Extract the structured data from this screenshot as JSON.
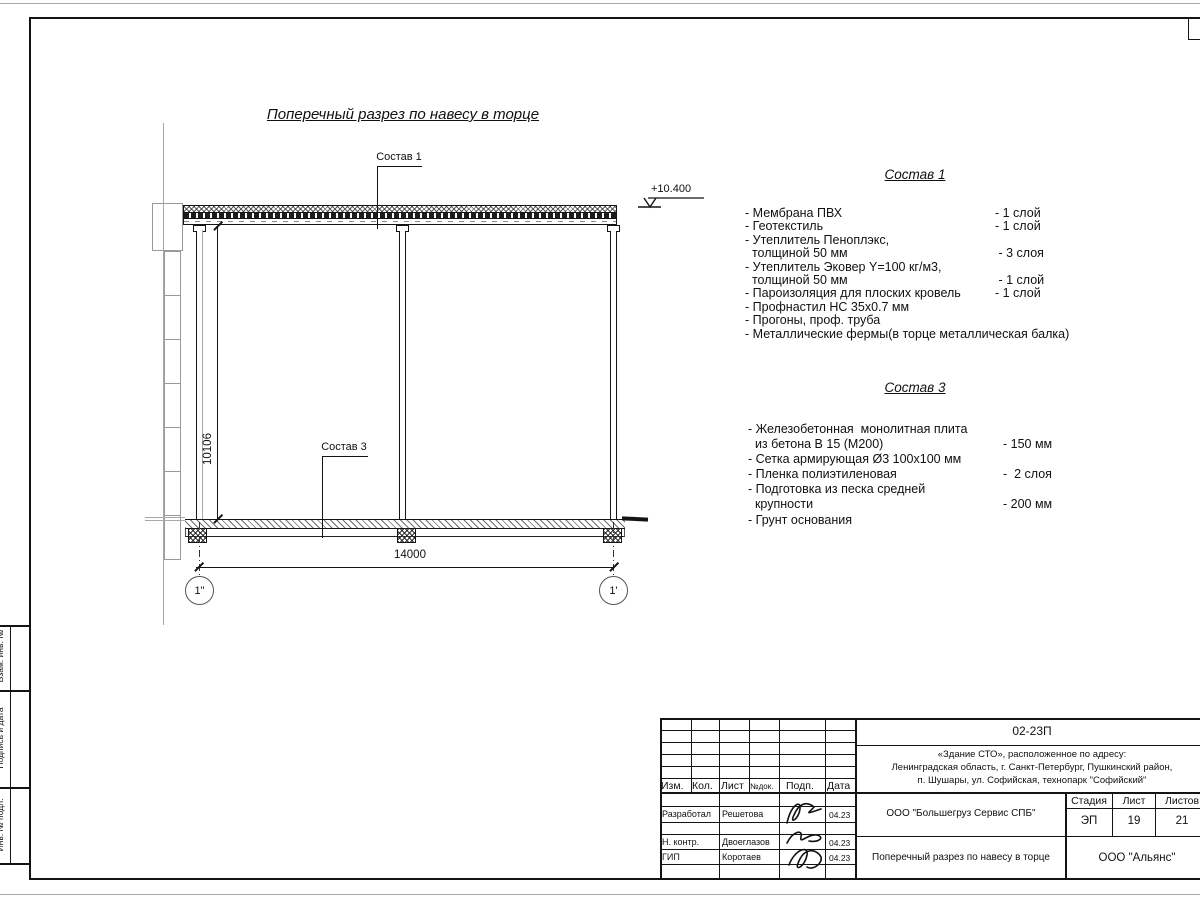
{
  "drawing": {
    "title": "Поперечный разрез по навесу в торце",
    "callout1": "Состав 1",
    "callout3": "Состав 3",
    "elevation": "+10.400",
    "dim_height": "10106",
    "dim_span": "14000",
    "axis_left": "1\"",
    "axis_right": "1'"
  },
  "compo1": {
    "title": "Состав 1",
    "rows": [
      {
        "t": "- Мембрана ПВХ",
        "v": "- 1 слой"
      },
      {
        "t": "- Геотекстиль",
        "v": "- 1 слой"
      },
      {
        "t": "- Утеплитель Пеноплэкс,",
        "v": ""
      },
      {
        "t": "  толщиной 50 мм",
        "v": " - 3 слоя"
      },
      {
        "t": "- Утеплитель Эковер Y=100 кг/м3,",
        "v": ""
      },
      {
        "t": "  толщиной 50 мм",
        "v": " - 1 слой"
      },
      {
        "t": "- Пароизоляция для плоских кровель",
        "v": "- 1 слой"
      },
      {
        "t": "- Профнастил НС 35х0.7 мм",
        "v": ""
      },
      {
        "t": "- Прогоны, проф. труба",
        "v": ""
      },
      {
        "t": "- Металлические фермы(в торце металлическая балка)",
        "v": ""
      }
    ]
  },
  "compo3": {
    "title": "Состав 3",
    "rows": [
      {
        "t": "- Железобетонная  монолитная плита",
        "v": ""
      },
      {
        "t": "  из бетона В 15 (М200)",
        "v": "- 150 мм"
      },
      {
        "t": "- Сетка армирующая Ø3 100x100 мм",
        "v": ""
      },
      {
        "t": "- Пленка полиэтиленовая",
        "v": "-  2 слоя"
      },
      {
        "t": "- Подготовка из песка средней",
        "v": ""
      },
      {
        "t": "  крупности",
        "v": "- 200 мм"
      },
      {
        "t": "- Грунт основания",
        "v": ""
      }
    ]
  },
  "titleblock": {
    "doc_number": "02-23П",
    "address_line1": "«Здание СТО», расположенное по адресу:",
    "address_line2": "Ленинградская область, г. Санкт-Петербург, Пушкинский район,",
    "address_line3": "п. Шушары, ул. Софийская, технопарк \"Софийский\"",
    "col_izm": "Изм.",
    "col_kol": "Кол.",
    "col_list": "Лист",
    "col_ndok": "№док.",
    "col_podp": "Подп.",
    "col_data": "Дата",
    "row1_role": "Разработал",
    "row1_name": "Решетова",
    "row1_date": "04.23",
    "row2_role": "Н. контр.",
    "row2_name": "Двоеглазов",
    "row2_date": "04.23",
    "row3_role": "ГИП",
    "row3_name": "Коротаев",
    "row3_date": "04.23",
    "company": "ООО \"Большегруз Сервис СПБ\"",
    "sheet_title": "Поперечный разрез по навесу в торце",
    "stage_label": "Стадия",
    "sheet_label": "Лист",
    "sheets_label": "Листов",
    "stage": "ЭП",
    "sheet_num": "19",
    "sheets_total": "21",
    "org": "ООО \"Альянс\""
  },
  "side_labels": {
    "l1": "Взам. инв. №",
    "l2": "Подпись и дата",
    "l3": "Инв. № подл."
  }
}
